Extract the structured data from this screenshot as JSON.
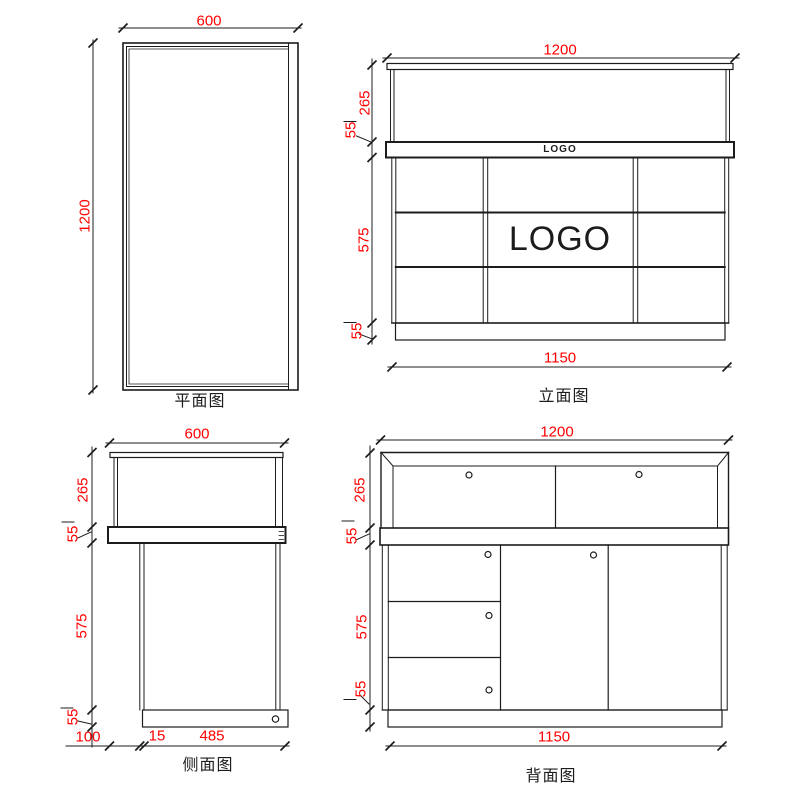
{
  "page": {
    "background": "#ffffff",
    "dimension_color": "#ff0000",
    "line_color": "#1c1c1c"
  },
  "views": {
    "plan": {
      "label": "平面图",
      "width_dim": "600",
      "height_dim": "1200"
    },
    "elevation": {
      "label": "立面图",
      "width_dim": "1200",
      "bottom_width_dim": "1150",
      "height_top": "265",
      "height_counter": "55",
      "height_body": "575",
      "height_base": "55",
      "band_logo_text": "LOGO",
      "panel_logo_text": "LOGO"
    },
    "side": {
      "label": "侧面图",
      "width_dim": "600",
      "height_top": "265",
      "height_counter": "55",
      "height_body": "575",
      "height_base": "55",
      "bottom_offset_dim": "100",
      "bottom_gap_dim": "15",
      "bottom_body_dim": "485"
    },
    "back": {
      "label": "背面图",
      "width_dim": "1200",
      "bottom_width_dim": "1150",
      "height_top": "265",
      "height_counter": "55",
      "height_body": "575",
      "height_base": "55"
    }
  }
}
